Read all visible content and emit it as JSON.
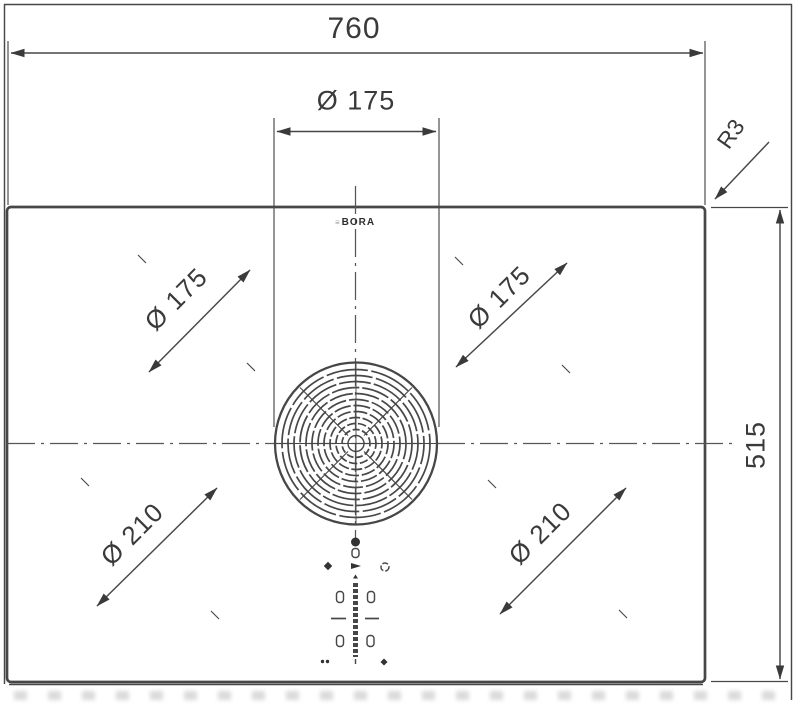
{
  "drawing": {
    "brand": {
      "logo_text": "BORA"
    },
    "dimensions": {
      "width": "760",
      "height": "515",
      "corner_radius": "R3",
      "cutout_top": "Ø 175",
      "upper_left": "Ø 175",
      "upper_right": "Ø 175",
      "lower_left": "Ø 210",
      "lower_right": "Ø 210"
    },
    "colors": {
      "line": "#474747",
      "text": "#3a3a3a",
      "background": "#ffffff"
    },
    "icons": [
      "air-inlet-grate-icon",
      "power-dot-icon",
      "socket-outline-icon",
      "diamond-icon",
      "pointer-arrow-icon",
      "notched-ring-icon",
      "up-arrow-icon",
      "slider-strip-icon",
      "zone-upper-left-icon",
      "zone-upper-right-icon",
      "minus-left-icon",
      "minus-right-icon",
      "zone-lower-left-icon",
      "zone-lower-right-icon",
      "dots-icon",
      "tick-icon",
      "diamond-small-icon"
    ]
  }
}
